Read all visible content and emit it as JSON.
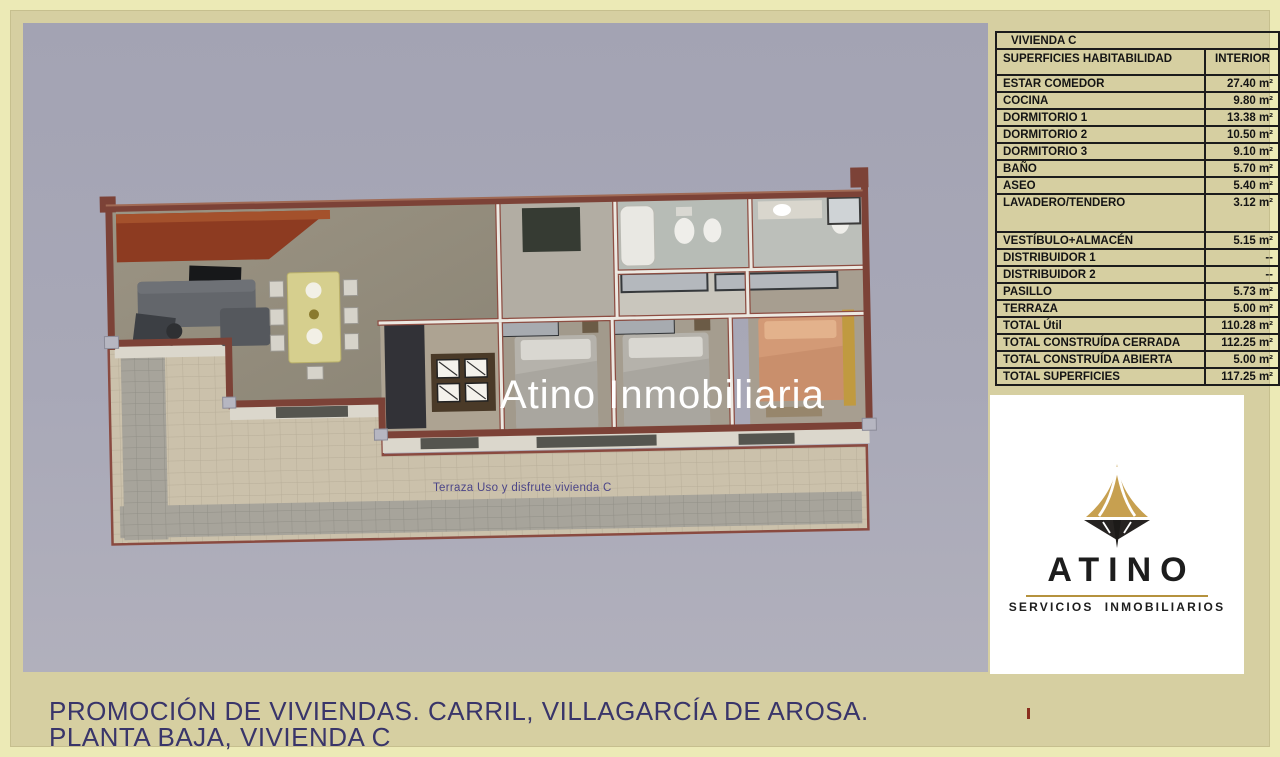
{
  "watermark": "Atino Inmobiliaria",
  "plan": {
    "terrace_label": "Terraza Uso y disfrute vivienda C"
  },
  "table": {
    "title": "VIVIENDA C",
    "header": {
      "label": "SUPERFICIES HABITABILIDAD",
      "value": "INTERIOR"
    },
    "rows": [
      {
        "label": "ESTAR COMEDOR",
        "value": "27.40 m²"
      },
      {
        "label": "COCINA",
        "value": "9.80 m²"
      },
      {
        "label": "DORMITORIO 1",
        "value": "13.38 m²"
      },
      {
        "label": "DORMITORIO 2",
        "value": "10.50 m²"
      },
      {
        "label": "DORMITORIO 3",
        "value": "9.10 m²"
      },
      {
        "label": "BAÑO",
        "value": "5.70 m²"
      },
      {
        "label": "ASEO",
        "value": "5.40 m²"
      },
      {
        "label": "LAVADERO/TENDERO",
        "value": "3.12 m²",
        "tall": true
      },
      {
        "label": "VESTÍBULO+ALMACÉN",
        "value": "5.15 m²"
      },
      {
        "label": "DISTRIBUIDOR 1",
        "value": "--"
      },
      {
        "label": "DISTRIBUIDOR 2",
        "value": "--"
      },
      {
        "label": "PASILLO",
        "value": "5.73 m²"
      },
      {
        "label": "TERRAZA",
        "value": "5.00 m²"
      },
      {
        "label": "TOTAL Útil",
        "value": "110.28 m²"
      },
      {
        "label": "TOTAL CONSTRUÍDA CERRADA",
        "value": "112.25 m²"
      },
      {
        "label": "TOTAL CONSTRUÍDA ABIERTA",
        "value": "5.00 m²"
      },
      {
        "label": "TOTAL SUPERFICIES",
        "value": "117.25 m²"
      }
    ]
  },
  "logo": {
    "name": "ATINO",
    "subtitle": "SERVICIOS  INMOBILIARIOS"
  },
  "caption": {
    "line1": "PROMOCIÓN DE VIVIENDAS. CARRIL, VILLAGARCÍA DE AROSA.",
    "line2": "PLANTA BAJA, VIVIENDA C"
  },
  "colors": {
    "outer_border": "#eceab6",
    "panel_khaki": "#d6cfa1",
    "plan_background_grey": "#a7a7b6",
    "caption_text": "#39356a",
    "table_border": "#1c1c1c",
    "brick_wall": "#7c4237",
    "terrace_tile": "#cbc1ab",
    "logo_gold": "#c7a050",
    "logo_dark": "#262321",
    "watermark_white": "#ffffff"
  }
}
